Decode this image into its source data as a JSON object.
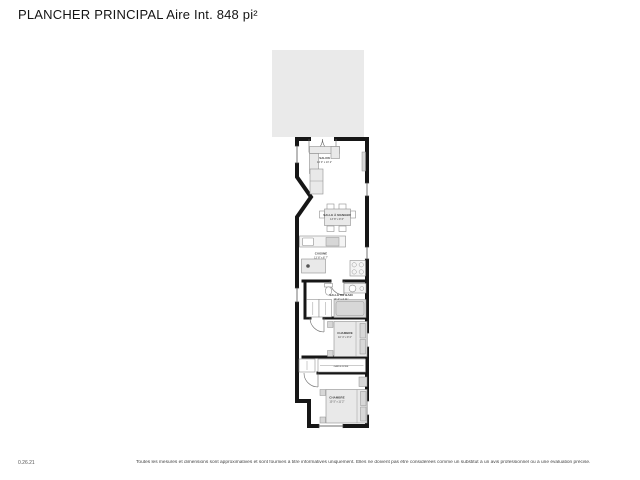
{
  "header": {
    "title": "PLANCHER PRINCIPAL Aire Int. 848 pi²"
  },
  "plan": {
    "rooms": [
      {
        "id": "salon",
        "name": "SALON",
        "dims": "14' 0\" x 10' 2\""
      },
      {
        "id": "salle-a-manger",
        "name": "SALLE À MANGER",
        "dims": "13' 8\" x 9' 6\""
      },
      {
        "id": "cuisine",
        "name": "CUISINE",
        "dims": "13' 8\" x 8' 7\""
      },
      {
        "id": "salle-de-bain",
        "name": "SALLE DE BAIN",
        "dims": "10' 4\" x 4' 11\""
      },
      {
        "id": "chambre-1",
        "name": "CHAMBRE",
        "dims": "10' 4\" x 9' 0\""
      },
      {
        "id": "garde-robe",
        "name": "GARDE-ROBE",
        "dims": ""
      },
      {
        "id": "chambre-2",
        "name": "CHAMBRE",
        "dims": "10' 5\" x 11' 2\""
      }
    ],
    "furniture_symbols": [
      "sectional-sofa",
      "tv-unit",
      "cabinet",
      "dining-table",
      "dining-chairs",
      "kitchen-counter",
      "kitchen-sink",
      "range",
      "island",
      "cooktop",
      "toilet",
      "vanity-sink",
      "bathtub",
      "closet-hangers",
      "wardrobe-rod",
      "double-bed",
      "pillows",
      "nightstand",
      "dresser"
    ],
    "colors": {
      "wall": "#161616",
      "deck": "#eaeaea",
      "furniture_fill": "#e9e9e9",
      "furniture_stroke": "#8f8f8f",
      "label_text": "#3a3a3a",
      "dims_text": "#8a8a8a"
    }
  },
  "footer": {
    "version": "0.26.21",
    "disclaimer": "Toutes les mesures et dimensions sont approximatives et sont fournies à titre informatives uniquement. Elles ne doivent pas être considérées comme un substitut à un avis professionnel ou à une évaluation précise."
  }
}
